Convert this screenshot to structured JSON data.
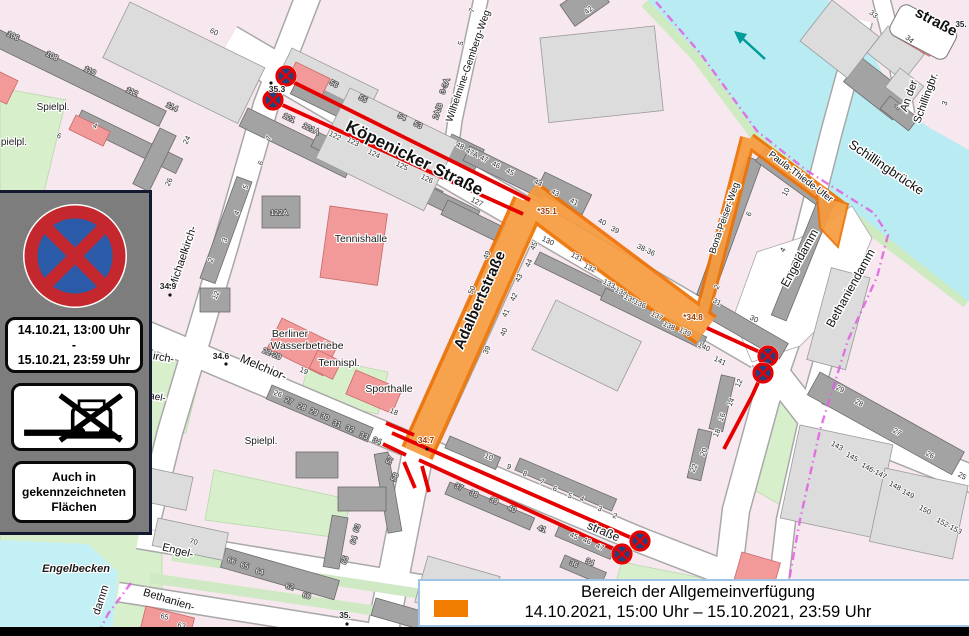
{
  "legend": {
    "title": "Bereich der Allgemeinverfügung",
    "period": "14.10.2021, 15:00 Uhr – 15.10.2021, 23:59 Uhr",
    "swatch_color": "#F07D00"
  },
  "sign_panel": {
    "signs": [
      "no-stopping-sign",
      "tow-away-sign"
    ],
    "validity": [
      "14.10.21, 13:00 Uhr",
      "-",
      "15.10.21, 23:59 Uhr"
    ],
    "note": [
      "Auch in",
      "gekennzeichneten",
      "Flächen"
    ]
  },
  "map": {
    "colors": {
      "zone_fill": "#F79B3D",
      "zone_border": "#EE7203",
      "restriction_line": "#E60000",
      "water": "#B9ECF2",
      "green": "#D8EFCC",
      "boundary": "#E25EE2",
      "flow_arrow": "#009B9B",
      "sign_blue": "#2A5AA8",
      "sign_red": "#C4272E"
    },
    "street_labels": [
      {
        "t": "Köpenicker Straße",
        "x": 412,
        "y": 163,
        "r": 26,
        "s": 17,
        "b": 1
      },
      {
        "t": "Adalbertstraße",
        "x": 484,
        "y": 302,
        "r": -66,
        "s": 15,
        "b": 1
      },
      {
        "t": "Wilhelmine-Gemberg-Weg",
        "x": 471,
        "y": 67,
        "r": -71,
        "s": 10
      },
      {
        "t": "Michaelkirch-",
        "x": 186,
        "y": 258,
        "r": -71,
        "s": 11
      },
      {
        "t": "irch-",
        "x": 163,
        "y": 361,
        "r": 10,
        "s": 11
      },
      {
        "t": "ael-",
        "x": 157,
        "y": 400,
        "r": 10,
        "s": 10
      },
      {
        "t": "Melchior-",
        "x": 262,
        "y": 371,
        "r": 23,
        "s": 12
      },
      {
        "t": "straße",
        "x": 602,
        "y": 535,
        "r": 23,
        "s": 12
      },
      {
        "t": "Engeldamm",
        "x": 803,
        "y": 260,
        "r": -61,
        "s": 12
      },
      {
        "t": "Bethaniendamm",
        "x": 854,
        "y": 290,
        "r": -61,
        "s": 12
      },
      {
        "t": "Schillingbrücke",
        "x": 884,
        "y": 171,
        "r": 34,
        "s": 13
      },
      {
        "t": "An der",
        "x": 912,
        "y": 97,
        "r": -70,
        "s": 11
      },
      {
        "t": "Schillingbr.",
        "x": 929,
        "y": 99,
        "r": -70,
        "s": 11
      },
      {
        "t": "straße",
        "x": 934,
        "y": 26,
        "r": 28,
        "s": 15,
        "b": 1
      },
      {
        "t": "Paula-Thiede-Ufer",
        "x": 799,
        "y": 179,
        "r": 37,
        "s": 9.5
      },
      {
        "t": "Bona-Peiser-Weg",
        "x": 727,
        "y": 219,
        "r": -71,
        "s": 9.5
      },
      {
        "t": "Engel-",
        "x": 177,
        "y": 554,
        "r": 14,
        "s": 11
      },
      {
        "t": "Bethanien-",
        "x": 168,
        "y": 603,
        "r": 17,
        "s": 11
      },
      {
        "t": "damm",
        "x": 104,
        "y": 601,
        "r": -72,
        "s": 11
      }
    ],
    "place_labels": [
      {
        "t": "Engelbecken",
        "x": 76,
        "y": 572,
        "s": 11,
        "i": 1,
        "c": "#0AA0B4",
        "b": 1
      },
      {
        "t": "Tennishalle",
        "x": 361,
        "y": 242,
        "s": 10.5
      },
      {
        "t": "Berliner",
        "x": 290,
        "y": 337,
        "s": 10.5
      },
      {
        "t": "Wasserbetriebe",
        "x": 307,
        "y": 349,
        "s": 10.5
      },
      {
        "t": "Tennispl.",
        "x": 339,
        "y": 366,
        "s": 10.5
      },
      {
        "t": "Sporthalle",
        "x": 389,
        "y": 392,
        "s": 10.5
      },
      {
        "t": "Spielpl.",
        "x": 261,
        "y": 444,
        "s": 10
      },
      {
        "t": "Spielpl.",
        "x": 53,
        "y": 110,
        "s": 10
      },
      {
        "t": "pielpl.",
        "x": 14,
        "y": 145,
        "s": 10
      }
    ],
    "ref_labels": [
      {
        "t": "35.3",
        "x": 277,
        "y": 92,
        "s": 8.5,
        "c": "#222"
      },
      {
        "t": "*35.1",
        "x": 547,
        "y": 214,
        "s": 8.5,
        "c": "#9C3A00"
      },
      {
        "t": "34.9",
        "x": 168,
        "y": 289,
        "s": 8.5,
        "c": "#222"
      },
      {
        "t": "34.6",
        "x": 221,
        "y": 359,
        "s": 8.5,
        "c": "#222"
      },
      {
        "t": "34.7",
        "x": 426,
        "y": 443,
        "s": 8.5,
        "c": "#9C3A00"
      },
      {
        "t": "*34.8",
        "x": 693,
        "y": 320,
        "s": 8.5,
        "c": "#9C3A00"
      },
      {
        "t": "35.",
        "x": 345,
        "y": 618,
        "s": 8.5,
        "c": "#222"
      },
      {
        "t": "35.",
        "x": 961,
        "y": 27,
        "s": 8,
        "c": "#222"
      }
    ],
    "dots": [
      [
        271,
        83
      ],
      [
        170,
        295
      ],
      [
        226,
        364
      ],
      [
        427,
        449
      ],
      [
        347,
        624
      ]
    ],
    "no_stopping_markers": [
      [
        286,
        76
      ],
      [
        273,
        100
      ],
      [
        768,
        356
      ],
      [
        763,
        373
      ],
      [
        640,
        541
      ],
      [
        622,
        554
      ]
    ],
    "house_numbers": [
      {
        "t": "56",
        "x": 333,
        "y": 86,
        "r": 26,
        "w": 1
      },
      {
        "t": "55",
        "x": 362,
        "y": 101,
        "r": 26,
        "w": 1
      },
      {
        "t": "54",
        "x": 401,
        "y": 119,
        "r": 26,
        "w": 1
      },
      {
        "t": "53",
        "x": 417,
        "y": 127,
        "r": 26,
        "w": 1
      },
      {
        "t": "48",
        "x": 459,
        "y": 148,
        "r": 26
      },
      {
        "t": "47A",
        "x": 471,
        "y": 155,
        "r": 26
      },
      {
        "t": "47",
        "x": 483,
        "y": 161,
        "r": 26
      },
      {
        "t": "46",
        "x": 495,
        "y": 167,
        "r": 26
      },
      {
        "t": "45",
        "x": 509,
        "y": 174,
        "r": 26
      },
      {
        "t": "44",
        "x": 537,
        "y": 185,
        "r": 26
      },
      {
        "t": "43",
        "x": 554,
        "y": 195,
        "r": 26
      },
      {
        "t": "41",
        "x": 573,
        "y": 204,
        "r": 26
      },
      {
        "t": "40",
        "x": 601,
        "y": 224,
        "r": 26
      },
      {
        "t": "39",
        "x": 614,
        "y": 232,
        "r": 26
      },
      {
        "t": "38-36",
        "x": 645,
        "y": 252,
        "r": 26
      },
      {
        "t": "121",
        "x": 288,
        "y": 120,
        "r": 26,
        "w": 1
      },
      {
        "t": "121A",
        "x": 310,
        "y": 131,
        "r": 26,
        "w": 1
      },
      {
        "t": "122",
        "x": 334,
        "y": 138,
        "r": 26
      },
      {
        "t": "123",
        "x": 352,
        "y": 144,
        "r": 26
      },
      {
        "t": "124",
        "x": 373,
        "y": 156,
        "r": 26
      },
      {
        "t": "125",
        "x": 401,
        "y": 168,
        "r": 26
      },
      {
        "t": "126",
        "x": 426,
        "y": 181,
        "r": 26
      },
      {
        "t": "127",
        "x": 476,
        "y": 204,
        "r": 26
      },
      {
        "t": "122A",
        "x": 279,
        "y": 215,
        "r": 0,
        "w": 1
      },
      {
        "t": "130",
        "x": 547,
        "y": 243,
        "r": 26
      },
      {
        "t": "131",
        "x": 576,
        "y": 259,
        "r": 26
      },
      {
        "t": "132",
        "x": 589,
        "y": 270,
        "r": 26
      },
      {
        "t": "133",
        "x": 608,
        "y": 286,
        "r": 26
      },
      {
        "t": "134",
        "x": 620,
        "y": 294,
        "r": 26
      },
      {
        "t": "135",
        "x": 629,
        "y": 301,
        "r": 26
      },
      {
        "t": "136",
        "x": 639,
        "y": 306,
        "r": 26
      },
      {
        "t": "137",
        "x": 656,
        "y": 318,
        "r": 26
      },
      {
        "t": "138",
        "x": 668,
        "y": 328,
        "r": 26
      },
      {
        "t": "139",
        "x": 684,
        "y": 334,
        "r": 26
      },
      {
        "t": "140",
        "x": 703,
        "y": 349,
        "r": 26
      },
      {
        "t": "141",
        "x": 719,
        "y": 363,
        "r": 26
      },
      {
        "t": "49",
        "x": 489,
        "y": 256,
        "r": -66
      },
      {
        "t": "50",
        "x": 474,
        "y": 291,
        "r": -66
      },
      {
        "t": "45",
        "x": 536,
        "y": 247,
        "r": -66
      },
      {
        "t": "44",
        "x": 531,
        "y": 264,
        "r": -66
      },
      {
        "t": "43",
        "x": 521,
        "y": 279,
        "r": -66
      },
      {
        "t": "42",
        "x": 516,
        "y": 298,
        "r": -66
      },
      {
        "t": "41",
        "x": 508,
        "y": 314,
        "r": -66
      },
      {
        "t": "40",
        "x": 506,
        "y": 333,
        "r": -66
      },
      {
        "t": "39",
        "x": 489,
        "y": 351,
        "r": -66
      },
      {
        "t": "10",
        "x": 788,
        "y": 193,
        "r": -62
      },
      {
        "t": "6",
        "x": 751,
        "y": 215,
        "r": -62
      },
      {
        "t": "4",
        "x": 785,
        "y": 251,
        "r": -62
      },
      {
        "t": "2",
        "x": 719,
        "y": 288,
        "r": -62
      },
      {
        "t": "31",
        "x": 716,
        "y": 304,
        "r": 26
      },
      {
        "t": "30",
        "x": 753,
        "y": 321,
        "r": 26
      },
      {
        "t": "5",
        "x": 248,
        "y": 188,
        "r": -66
      },
      {
        "t": "4",
        "x": 239,
        "y": 214,
        "r": -66
      },
      {
        "t": "3",
        "x": 227,
        "y": 241,
        "r": -66
      },
      {
        "t": "2",
        "x": 213,
        "y": 261,
        "r": -66
      },
      {
        "t": "12",
        "x": 218,
        "y": 296,
        "r": -66
      },
      {
        "t": "7",
        "x": 271,
        "y": 139,
        "r": -66
      },
      {
        "t": "6",
        "x": 263,
        "y": 164,
        "r": -66
      },
      {
        "t": "60",
        "x": 213,
        "y": 34,
        "r": 26
      },
      {
        "t": "106",
        "x": 12,
        "y": 38,
        "r": 26,
        "w": 1
      },
      {
        "t": "108",
        "x": 51,
        "y": 58,
        "r": 26,
        "w": 1
      },
      {
        "t": "110",
        "x": 89,
        "y": 73,
        "r": 26,
        "w": 1
      },
      {
        "t": "112",
        "x": 131,
        "y": 94,
        "r": 26,
        "w": 1
      },
      {
        "t": "114",
        "x": 171,
        "y": 109,
        "r": 26,
        "w": 1
      },
      {
        "t": "4",
        "x": 94,
        "y": 128,
        "r": 26
      },
      {
        "t": "6",
        "x": 58,
        "y": 138,
        "r": 26
      },
      {
        "t": "24",
        "x": 189,
        "y": 141,
        "r": -64
      },
      {
        "t": "26",
        "x": 171,
        "y": 183,
        "r": -64
      },
      {
        "t": "7",
        "x": 474,
        "y": 11,
        "r": -71
      },
      {
        "t": "5",
        "x": 463,
        "y": 44,
        "r": -71
      },
      {
        "t": "3-3A",
        "x": 447,
        "y": 87,
        "r": -71,
        "w": 1
      },
      {
        "t": "2A/B",
        "x": 440,
        "y": 112,
        "r": -71,
        "w": 1
      },
      {
        "t": "42",
        "x": 590,
        "y": 12,
        "r": -40
      },
      {
        "t": "22-20",
        "x": 271,
        "y": 356,
        "r": 23,
        "w": 1
      },
      {
        "t": "19",
        "x": 303,
        "y": 373,
        "r": 23
      },
      {
        "t": "18",
        "x": 393,
        "y": 414,
        "r": 23
      },
      {
        "t": "26",
        "x": 277,
        "y": 396,
        "r": 23
      },
      {
        "t": "27",
        "x": 288,
        "y": 403,
        "r": 23,
        "w": 1
      },
      {
        "t": "28",
        "x": 301,
        "y": 409,
        "r": 23,
        "w": 1
      },
      {
        "t": "29",
        "x": 313,
        "y": 414,
        "r": 23,
        "w": 1
      },
      {
        "t": "30",
        "x": 324,
        "y": 419,
        "r": 23,
        "w": 1
      },
      {
        "t": "31",
        "x": 336,
        "y": 426,
        "r": 23,
        "w": 1
      },
      {
        "t": "32",
        "x": 349,
        "y": 431,
        "r": 23,
        "w": 1
      },
      {
        "t": "33",
        "x": 363,
        "y": 438,
        "r": 23,
        "w": 1
      },
      {
        "t": "34",
        "x": 376,
        "y": 443,
        "r": 23,
        "w": 1
      },
      {
        "t": "57",
        "x": 392,
        "y": 461,
        "r": -66,
        "w": 1
      },
      {
        "t": "58",
        "x": 397,
        "y": 478,
        "r": -66,
        "w": 1
      },
      {
        "t": "10",
        "x": 488,
        "y": 459,
        "r": 23
      },
      {
        "t": "9",
        "x": 508,
        "y": 469,
        "r": 23
      },
      {
        "t": "8",
        "x": 524,
        "y": 476,
        "r": 23
      },
      {
        "t": "7",
        "x": 541,
        "y": 484,
        "r": 23
      },
      {
        "t": "6",
        "x": 554,
        "y": 491,
        "r": 23
      },
      {
        "t": "5",
        "x": 569,
        "y": 498,
        "r": 23
      },
      {
        "t": "4",
        "x": 581,
        "y": 501,
        "r": 23
      },
      {
        "t": "3",
        "x": 599,
        "y": 511,
        "r": 23
      },
      {
        "t": "2",
        "x": 614,
        "y": 518,
        "r": 23
      },
      {
        "t": "37",
        "x": 458,
        "y": 489,
        "r": 23,
        "w": 1
      },
      {
        "t": "38",
        "x": 473,
        "y": 496,
        "r": 23,
        "w": 1
      },
      {
        "t": "39",
        "x": 493,
        "y": 503,
        "r": 23,
        "w": 1
      },
      {
        "t": "40",
        "x": 511,
        "y": 511,
        "r": 23,
        "w": 1
      },
      {
        "t": "41",
        "x": 541,
        "y": 531,
        "r": 23,
        "w": 1
      },
      {
        "t": "45",
        "x": 573,
        "y": 538,
        "r": 23
      },
      {
        "t": "46",
        "x": 586,
        "y": 543,
        "r": 23
      },
      {
        "t": "47",
        "x": 599,
        "y": 549,
        "r": 23
      },
      {
        "t": "36",
        "x": 573,
        "y": 566,
        "r": 23,
        "w": 1
      },
      {
        "t": "34",
        "x": 589,
        "y": 564,
        "r": 23,
        "w": 1
      },
      {
        "t": "12",
        "x": 741,
        "y": 384,
        "r": -66
      },
      {
        "t": "14",
        "x": 733,
        "y": 403,
        "r": -66
      },
      {
        "t": "16",
        "x": 724,
        "y": 418,
        "r": -66
      },
      {
        "t": "18",
        "x": 719,
        "y": 434,
        "r": -66
      },
      {
        "t": "20",
        "x": 706,
        "y": 453,
        "r": -66
      },
      {
        "t": "22",
        "x": 696,
        "y": 469,
        "r": -66
      },
      {
        "t": "29",
        "x": 839,
        "y": 391,
        "r": 28
      },
      {
        "t": "28",
        "x": 858,
        "y": 405,
        "r": 28
      },
      {
        "t": "27",
        "x": 896,
        "y": 434,
        "r": 28
      },
      {
        "t": "26",
        "x": 929,
        "y": 457,
        "r": 28
      },
      {
        "t": "25",
        "x": 961,
        "y": 478,
        "r": 28
      },
      {
        "t": "143",
        "x": 836,
        "y": 448,
        "r": 28
      },
      {
        "t": "145",
        "x": 851,
        "y": 459,
        "r": 28
      },
      {
        "t": "146-147",
        "x": 873,
        "y": 473,
        "r": 28
      },
      {
        "t": "148",
        "x": 894,
        "y": 488,
        "r": 28
      },
      {
        "t": "149",
        "x": 907,
        "y": 496,
        "r": 28
      },
      {
        "t": "150",
        "x": 924,
        "y": 512,
        "r": 28
      },
      {
        "t": "152-153",
        "x": 948,
        "y": 528,
        "r": 28
      },
      {
        "t": "33",
        "x": 872,
        "y": 16,
        "r": 40
      },
      {
        "t": "34",
        "x": 908,
        "y": 41,
        "r": 40
      },
      {
        "t": "2",
        "x": 915,
        "y": 82,
        "r": -70
      },
      {
        "t": "3",
        "x": 947,
        "y": 104,
        "r": -70
      },
      {
        "t": "4",
        "x": 900,
        "y": 108,
        "r": -70,
        "w": 1
      },
      {
        "t": "70",
        "x": 193,
        "y": 544,
        "r": 14
      },
      {
        "t": "66",
        "x": 231,
        "y": 563,
        "r": 14,
        "w": 1
      },
      {
        "t": "65",
        "x": 244,
        "y": 568,
        "r": 14,
        "w": 1
      },
      {
        "t": "64",
        "x": 259,
        "y": 574,
        "r": 14,
        "w": 1
      },
      {
        "t": "62",
        "x": 289,
        "y": 589,
        "r": 14,
        "w": 1
      },
      {
        "t": "60",
        "x": 306,
        "y": 598,
        "r": 14,
        "w": 1
      },
      {
        "t": "63",
        "x": 359,
        "y": 529,
        "r": -70,
        "w": 1
      },
      {
        "t": "64",
        "x": 356,
        "y": 541,
        "r": -70,
        "w": 1
      },
      {
        "t": "65",
        "x": 347,
        "y": 561,
        "r": -70,
        "w": 1
      },
      {
        "t": "65",
        "x": 164,
        "y": 619,
        "r": 14
      },
      {
        "t": "63",
        "x": 181,
        "y": 628,
        "r": 14
      }
    ]
  }
}
